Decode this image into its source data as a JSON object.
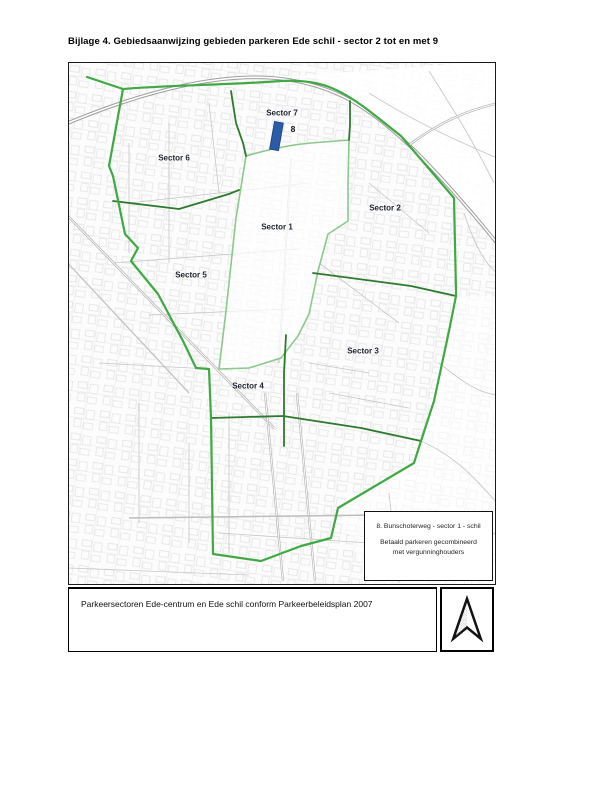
{
  "page": {
    "title": "Bijlage 4. Gebiedsaanwijzing gebieden parkeren Ede schil - sector 2 tot en met 9"
  },
  "map": {
    "sector_labels": [
      {
        "id": "sector-7",
        "label": "Sector 7",
        "x": 213,
        "y": 50
      },
      {
        "id": "sector-6",
        "label": "Sector 6",
        "x": 105,
        "y": 95
      },
      {
        "id": "sector-2",
        "label": "Sector 2",
        "x": 316,
        "y": 145
      },
      {
        "id": "sector-1",
        "label": "Sector 1",
        "x": 208,
        "y": 164
      },
      {
        "id": "sector-5",
        "label": "Sector 5",
        "x": 122,
        "y": 212
      },
      {
        "id": "sector-3",
        "label": "Sector 3",
        "x": 294,
        "y": 288
      },
      {
        "id": "sector-4",
        "label": "Sector 4",
        "x": 179,
        "y": 323
      }
    ],
    "area_marker": {
      "number": "8",
      "x": 224,
      "y": 66
    },
    "legend": {
      "line1": "8. Bunschoterweg - sector 1 - schil",
      "line2": "Betaald parkeren gecombineerd",
      "line3": "met vergunninghouders"
    },
    "colors": {
      "boundary_green": "#3fa944",
      "divider_green": "#2c7a2c",
      "centrum_green": "#8bc98b",
      "marker_blue": "#2a5ca8"
    }
  },
  "caption": {
    "text": "Parkeersectoren Ede-centrum en Ede schil conform Parkeerbeleidsplan 2007"
  }
}
